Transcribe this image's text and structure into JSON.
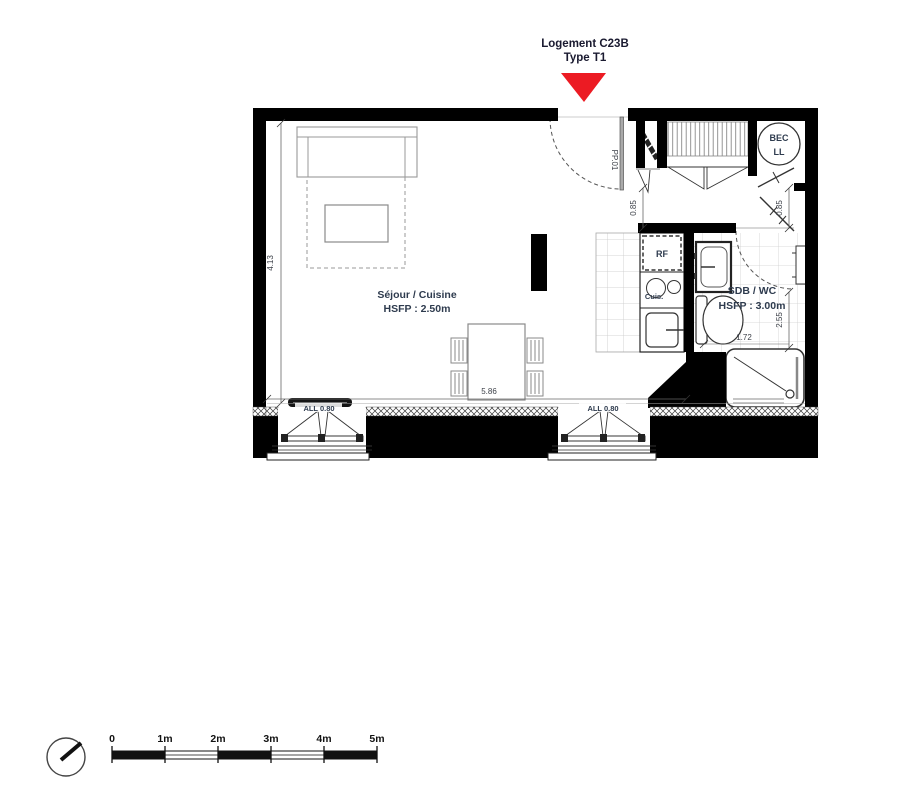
{
  "title": {
    "line1": "Logement C23B",
    "line2": "Type T1"
  },
  "colors": {
    "marker_red": "#EC1B23",
    "label_blue": "#2E3B4E",
    "wall": "#000000"
  },
  "rooms": {
    "sejour_cuisine": {
      "name": "Séjour / Cuisine",
      "ceiling_height": "HSFP : 2.50m"
    },
    "sdb_wc": {
      "name": "SDB / WC",
      "ceiling_height": "HSFP : 3.00m"
    }
  },
  "fixtures": {
    "fridge": "RF",
    "cooktop": "Cuis.",
    "water_heater_line1": "BEC",
    "water_heater_line2": "LL"
  },
  "doors": {
    "entry": "PP.01"
  },
  "windows": {
    "sill_left": "ALL 0.80",
    "sill_right": "ALL 0.80"
  },
  "dimensions": {
    "sejour_height": "4.13",
    "sejour_width": "5.86",
    "entry_clearance": "0.85",
    "hall_clearance": "0.85",
    "sdb_depth": "2.55",
    "sdb_width": "1.72"
  },
  "scalebar": {
    "labels": [
      "0",
      "1m",
      "2m",
      "3m",
      "4m",
      "5m"
    ]
  },
  "icons": {
    "north": "compass-icon",
    "unit_marker": "unit-location-marker-icon"
  }
}
